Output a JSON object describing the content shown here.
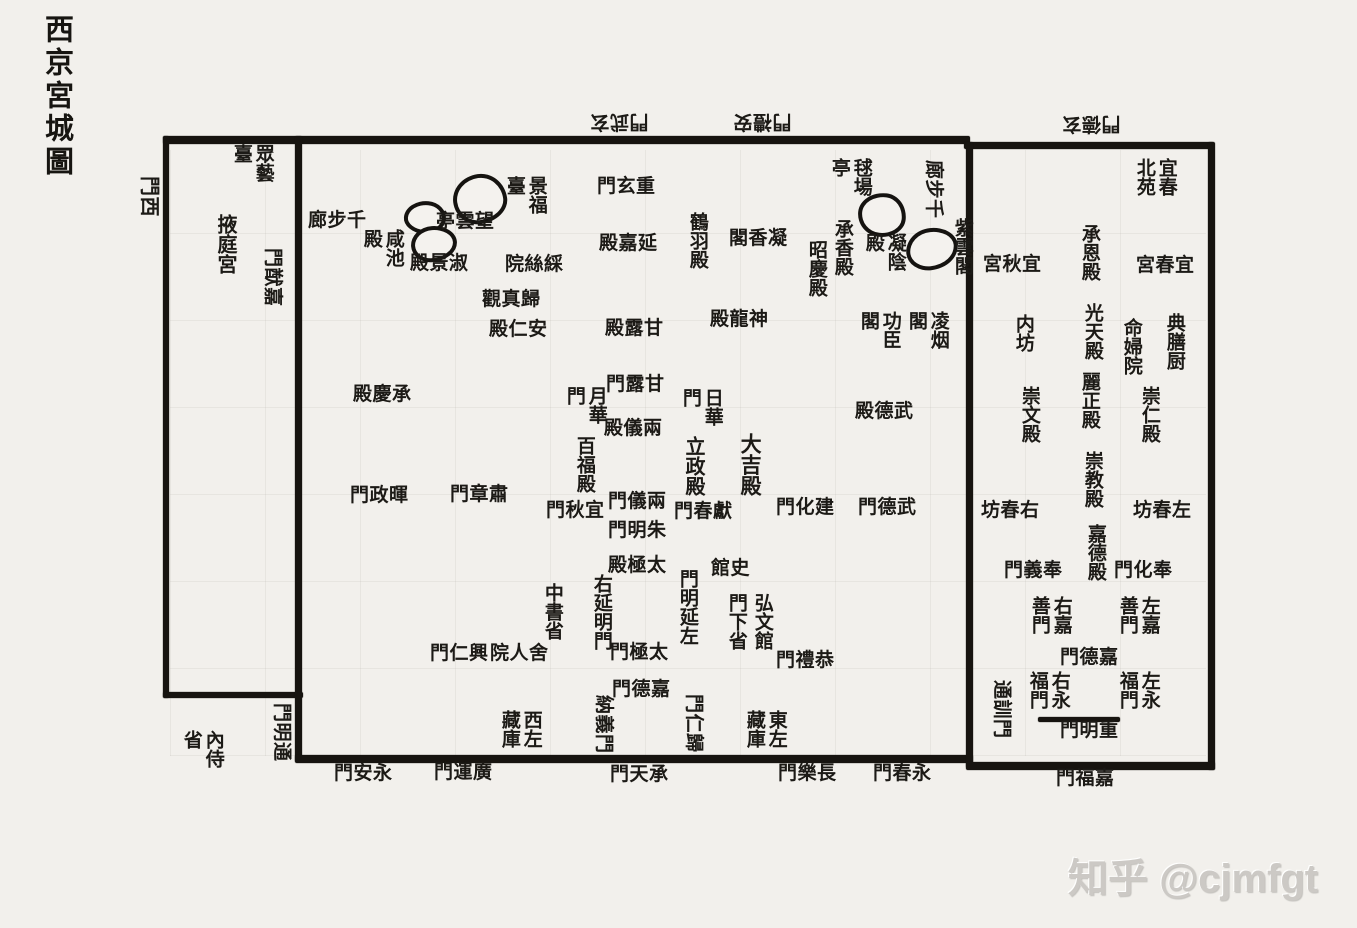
{
  "page": {
    "title_vertical": "西京宮城圖",
    "watermark": "知乎 @cjmfgt"
  },
  "colors": {
    "paper": "#f2f0ec",
    "ink": "#1c1a16",
    "wall": "#171410",
    "watermark": "#ccc9c5"
  },
  "map": {
    "width": 1357,
    "height": 928,
    "walls": [
      {
        "name": "north-wall-main",
        "x": 163,
        "y": 136,
        "w": 807,
        "h": 8
      },
      {
        "name": "north-wall-east",
        "x": 964,
        "y": 142,
        "w": 250,
        "h": 7
      },
      {
        "name": "west-wall",
        "x": 163,
        "y": 136,
        "w": 6,
        "h": 562
      },
      {
        "name": "yeting-south-wall",
        "x": 163,
        "y": 692,
        "w": 140,
        "h": 6
      },
      {
        "name": "yeting-east-wall",
        "x": 295,
        "y": 136,
        "w": 7,
        "h": 626
      },
      {
        "name": "south-wall-main",
        "x": 295,
        "y": 755,
        "w": 678,
        "h": 8
      },
      {
        "name": "eastpalace-west-wall",
        "x": 966,
        "y": 142,
        "w": 7,
        "h": 626
      },
      {
        "name": "eastpalace-east-wall",
        "x": 1208,
        "y": 142,
        "w": 7,
        "h": 628
      },
      {
        "name": "eastpalace-south-wall",
        "x": 966,
        "y": 762,
        "w": 249,
        "h": 8
      },
      {
        "name": "chongming-gate-bar",
        "x": 1038,
        "y": 717,
        "w": 82,
        "h": 5
      }
    ],
    "ponds": [
      {
        "name": "pond-1",
        "x": 453,
        "y": 174,
        "w": 46,
        "h": 42,
        "radius": "52% 48% 55% 45% / 50% 55% 45% 50%",
        "rot": -8
      },
      {
        "name": "pond-2",
        "x": 404,
        "y": 201,
        "w": 34,
        "h": 25,
        "radius": "55% 45% 50% 50% / 55% 50% 50% 45%",
        "rot": 5
      },
      {
        "name": "pond-3",
        "x": 411,
        "y": 226,
        "w": 38,
        "h": 28,
        "radius": "48% 52% 58% 42% / 52% 48% 52% 48%",
        "rot": -4
      },
      {
        "name": "pond-4",
        "x": 858,
        "y": 193,
        "w": 40,
        "h": 36,
        "radius": "55% 45% 52% 48% / 48% 55% 45% 52%",
        "rot": 6
      },
      {
        "name": "pond-5",
        "x": 906,
        "y": 228,
        "w": 44,
        "h": 34,
        "radius": "50% 50% 56% 44% / 55% 45% 55% 45%",
        "rot": -6
      }
    ],
    "labels": [
      {
        "name": "xuanwu-gate",
        "text": "門武玄",
        "reading": "玄武門",
        "x": 590,
        "y": 111,
        "mode": "h",
        "rot": 180
      },
      {
        "name": "anli-gate",
        "text": "門禮安",
        "reading": "安禮門",
        "x": 733,
        "y": 111,
        "mode": "h",
        "rot": 180
      },
      {
        "name": "xuande-gate",
        "text": "門德玄",
        "reading": "玄德門",
        "x": 1062,
        "y": 113,
        "mode": "h",
        "rot": 180
      },
      {
        "name": "xi-gate",
        "text": "門西",
        "reading": "西門",
        "x": 135,
        "y": 176,
        "mode": "h",
        "rot": 90,
        "size": 20
      },
      {
        "name": "jiayou-gate",
        "text": "門猷嘉",
        "reading": "嘉猷門",
        "x": 259,
        "y": 248,
        "mode": "h",
        "rot": 90
      },
      {
        "name": "tongming-gate",
        "text": "門明通",
        "reading": "通明門",
        "x": 268,
        "y": 703,
        "mode": "h",
        "rot": 90
      },
      {
        "name": "tongxun-gate",
        "text": "通訓門",
        "reading": "通訓門",
        "x": 988,
        "y": 680,
        "mode": "h",
        "rot": 90
      },
      {
        "name": "zhongyi-terrace",
        "text": "眾藝臺",
        "reading": "眾藝臺",
        "x": 230,
        "y": 144,
        "mode": "v",
        "colh": 2
      },
      {
        "name": "yeting-palace",
        "text": "掖庭宮",
        "reading": "掖庭宮",
        "x": 213,
        "y": 214,
        "mode": "v",
        "size": 20
      },
      {
        "name": "neishi-department",
        "text": "內侍省",
        "reading": "內侍省",
        "x": 180,
        "y": 730,
        "mode": "v",
        "colh": 2
      },
      {
        "name": "qianbulang-west",
        "text": "廊步千",
        "reading": "千步廊",
        "x": 308,
        "y": 211,
        "mode": "h"
      },
      {
        "name": "wangyun-pavilion",
        "text": "亭雲望",
        "reading": "望雲亭",
        "x": 436,
        "y": 212,
        "mode": "h"
      },
      {
        "name": "jingfu-terrace",
        "text": "景福臺",
        "reading": "景福臺",
        "x": 503,
        "y": 176,
        "mode": "v",
        "colh": 2
      },
      {
        "name": "xianchi-hall",
        "text": "咸池殿",
        "reading": "咸池殿",
        "x": 360,
        "y": 229,
        "mode": "v",
        "colh": 2
      },
      {
        "name": "shujing-hall",
        "text": "殿景淑",
        "reading": "淑景殿",
        "x": 410,
        "y": 254,
        "mode": "h"
      },
      {
        "name": "caisi-court",
        "text": "院絲綵",
        "reading": "綵絲院",
        "x": 505,
        "y": 255,
        "mode": "h"
      },
      {
        "name": "guizhen-abbey",
        "text": "觀真歸",
        "reading": "歸真觀",
        "x": 482,
        "y": 290,
        "mode": "h"
      },
      {
        "name": "anren-hall",
        "text": "殿仁安",
        "reading": "安仁殿",
        "x": 489,
        "y": 320,
        "mode": "h"
      },
      {
        "name": "chongxuan-gate",
        "text": "門玄重",
        "reading": "重玄門",
        "x": 597,
        "y": 177,
        "mode": "h"
      },
      {
        "name": "yanjia-hall",
        "text": "殿嘉延",
        "reading": "延嘉殿",
        "x": 599,
        "y": 234,
        "mode": "h"
      },
      {
        "name": "ganlu-hall",
        "text": "殿露甘",
        "reading": "甘露殿",
        "x": 605,
        "y": 319,
        "mode": "h"
      },
      {
        "name": "heyu-hall",
        "text": "鶴羽殿",
        "reading": "鶴羽殿",
        "x": 686,
        "y": 212,
        "mode": "v"
      },
      {
        "name": "ningxiang-pavilion",
        "text": "閣香凝",
        "reading": "凝香閣",
        "x": 729,
        "y": 229,
        "mode": "h"
      },
      {
        "name": "chengxiang-hall",
        "text": "承香殿",
        "reading": "承香殿",
        "x": 831,
        "y": 219,
        "mode": "v"
      },
      {
        "name": "zhaoqing-hall",
        "text": "昭慶殿",
        "reading": "昭慶殿",
        "x": 805,
        "y": 240,
        "mode": "v"
      },
      {
        "name": "qiuchang-pavilion",
        "text": "毬場亭",
        "reading": "毬場亭",
        "x": 828,
        "y": 158,
        "mode": "v",
        "colh": 2
      },
      {
        "name": "qianbulang-north",
        "text": "廊步千",
        "reading": "千步廊",
        "x": 920,
        "y": 160,
        "mode": "h",
        "rot": 90
      },
      {
        "name": "ziyun-pavilion",
        "text": "紫雲閣",
        "reading": "紫雲閣",
        "x": 951,
        "y": 218,
        "mode": "v"
      },
      {
        "name": "ningyin-hall",
        "text": "凝陰殿",
        "reading": "凝陰殿",
        "x": 862,
        "y": 233,
        "mode": "v",
        "colh": 2
      },
      {
        "name": "shenlong-hall",
        "text": "殿龍神",
        "reading": "神龍殿",
        "x": 710,
        "y": 310,
        "mode": "h"
      },
      {
        "name": "gongchen-pavilion",
        "text": "功臣閣",
        "reading": "功臣閣",
        "x": 857,
        "y": 311,
        "mode": "v",
        "colh": 2
      },
      {
        "name": "lingyan-pavilion",
        "text": "凌烟閣",
        "reading": "凌烟閣",
        "x": 905,
        "y": 311,
        "mode": "v",
        "colh": 2
      },
      {
        "name": "chengqing-hall",
        "text": "殿慶承",
        "reading": "承慶殿",
        "x": 353,
        "y": 385,
        "mode": "h"
      },
      {
        "name": "ganlu-gate",
        "text": "門露甘",
        "reading": "甘露門",
        "x": 606,
        "y": 375,
        "mode": "h"
      },
      {
        "name": "yuehua-gate",
        "text": "月華門",
        "reading": "月華門",
        "x": 563,
        "y": 386,
        "mode": "v",
        "colh": 2
      },
      {
        "name": "rihua-gate",
        "text": "日華門",
        "reading": "日華門",
        "x": 679,
        "y": 388,
        "mode": "v",
        "colh": 2
      },
      {
        "name": "liangyi-hall",
        "text": "殿儀兩",
        "reading": "兩儀殿",
        "x": 604,
        "y": 419,
        "mode": "h"
      },
      {
        "name": "baifu-hall",
        "text": "百福殿",
        "reading": "百福殿",
        "x": 573,
        "y": 436,
        "mode": "v"
      },
      {
        "name": "lizheng-hall",
        "text": "立政殿",
        "reading": "立政殿",
        "x": 681,
        "y": 436,
        "mode": "v",
        "size": 20
      },
      {
        "name": "daji-hall",
        "text": "大吉殿",
        "reading": "大吉殿",
        "x": 738,
        "y": 433,
        "mode": "v",
        "size": 21
      },
      {
        "name": "wude-hall",
        "text": "殿德武",
        "reading": "武德殿",
        "x": 855,
        "y": 402,
        "mode": "h"
      },
      {
        "name": "huizheng-gate",
        "text": "門政暉",
        "reading": "暉政門",
        "x": 350,
        "y": 486,
        "mode": "h"
      },
      {
        "name": "suzhang-gate",
        "text": "門章肅",
        "reading": "肅章門",
        "x": 450,
        "y": 485,
        "mode": "h"
      },
      {
        "name": "yiqiu-gate",
        "text": "門秋宜",
        "reading": "宜秋門",
        "x": 546,
        "y": 501,
        "mode": "h"
      },
      {
        "name": "liangyi-gate",
        "text": "門儀兩",
        "reading": "兩儀門",
        "x": 608,
        "y": 492,
        "mode": "h"
      },
      {
        "name": "zhuming-gate",
        "text": "門明朱",
        "reading": "朱明門",
        "x": 608,
        "y": 521,
        "mode": "h"
      },
      {
        "name": "xianchun-gate",
        "text": "門春獻",
        "reading": "獻春門",
        "x": 674,
        "y": 502,
        "mode": "h"
      },
      {
        "name": "jianhua-gate",
        "text": "門化建",
        "reading": "建化門",
        "x": 776,
        "y": 498,
        "mode": "h"
      },
      {
        "name": "wude-gate",
        "text": "門德武",
        "reading": "武德門",
        "x": 858,
        "y": 498,
        "mode": "h"
      },
      {
        "name": "taiji-hall",
        "text": "殿極太",
        "reading": "太極殿",
        "x": 608,
        "y": 556,
        "mode": "h"
      },
      {
        "name": "shi-guan",
        "text": "館史",
        "reading": "史館",
        "x": 711,
        "y": 559,
        "mode": "h"
      },
      {
        "name": "you-yanming-gate",
        "text": "右延明門",
        "reading": "右延明門",
        "x": 590,
        "y": 574,
        "mode": "v"
      },
      {
        "name": "zuo-yanming-gate",
        "text": "門明延左",
        "reading": "左延明門",
        "x": 676,
        "y": 569,
        "mode": "v"
      },
      {
        "name": "zhongshu-department",
        "text": "中書省",
        "reading": "中書省",
        "x": 541,
        "y": 583,
        "mode": "v"
      },
      {
        "name": "hongwen-academy",
        "text": "弘文館",
        "reading": "弘文館",
        "x": 751,
        "y": 593,
        "mode": "v"
      },
      {
        "name": "menxia-department",
        "text": "門下省",
        "reading": "門下省",
        "x": 725,
        "y": 593,
        "mode": "v"
      },
      {
        "name": "sheren-court",
        "text": "院人舍",
        "reading": "舍人院",
        "x": 490,
        "y": 644,
        "mode": "h"
      },
      {
        "name": "xingren-gate",
        "text": "門仁興",
        "reading": "興仁門",
        "x": 430,
        "y": 644,
        "mode": "h"
      },
      {
        "name": "taiji-gate",
        "text": "門極太",
        "reading": "太極門",
        "x": 610,
        "y": 643,
        "mode": "h"
      },
      {
        "name": "gongli-gate",
        "text": "門禮恭",
        "reading": "恭禮門",
        "x": 776,
        "y": 651,
        "mode": "h"
      },
      {
        "name": "jiade-gate-inner",
        "text": "門德嘉",
        "reading": "嘉德門",
        "x": 612,
        "y": 680,
        "mode": "h"
      },
      {
        "name": "nayi-gate",
        "text": "納義門",
        "reading": "納義門",
        "x": 590,
        "y": 695,
        "mode": "h",
        "rot": 90
      },
      {
        "name": "guiren-gate",
        "text": "門仁歸",
        "reading": "歸仁門",
        "x": 680,
        "y": 694,
        "mode": "h",
        "rot": 90
      },
      {
        "name": "west-zuocang-store",
        "text": "西左藏庫",
        "reading": "西左藏庫",
        "x": 498,
        "y": 710,
        "mode": "v",
        "colh": 2
      },
      {
        "name": "east-zuocang-store",
        "text": "東左藏庫",
        "reading": "東左藏庫",
        "x": 743,
        "y": 710,
        "mode": "v",
        "colh": 2
      },
      {
        "name": "yichun-north-park",
        "text": "宜春北苑",
        "reading": "宜春北苑",
        "x": 1133,
        "y": 158,
        "mode": "v",
        "colh": 2
      },
      {
        "name": "yiqiu-palace",
        "text": "宮秋宜",
        "reading": "宜秋宮",
        "x": 983,
        "y": 255,
        "mode": "h"
      },
      {
        "name": "chengen-hall",
        "text": "承恩殿",
        "reading": "承恩殿",
        "x": 1078,
        "y": 224,
        "mode": "v"
      },
      {
        "name": "yichun-palace",
        "text": "宮春宜",
        "reading": "宜春宮",
        "x": 1136,
        "y": 256,
        "mode": "h"
      },
      {
        "name": "nei-fang",
        "text": "内坊",
        "reading": "內坊",
        "x": 1012,
        "y": 314,
        "mode": "v"
      },
      {
        "name": "guangtian-hall",
        "text": "光天殿",
        "reading": "光天殿",
        "x": 1081,
        "y": 303,
        "mode": "v"
      },
      {
        "name": "dianshan-kitchen",
        "text": "典膳厨",
        "reading": "典膳厨",
        "x": 1163,
        "y": 313,
        "mode": "v"
      },
      {
        "name": "mingfu-court",
        "text": "命婦院",
        "reading": "命婦院",
        "x": 1120,
        "y": 318,
        "mode": "v"
      },
      {
        "name": "lizheng-hall-east",
        "text": "麗正殿",
        "reading": "麗正殿",
        "x": 1078,
        "y": 372,
        "mode": "v"
      },
      {
        "name": "chongwen-hall",
        "text": "崇文殿",
        "reading": "崇文殿",
        "x": 1018,
        "y": 386,
        "mode": "v"
      },
      {
        "name": "chongren-hall",
        "text": "崇仁殿",
        "reading": "崇仁殿",
        "x": 1138,
        "y": 386,
        "mode": "v"
      },
      {
        "name": "chongjiao-hall",
        "text": "崇教殿",
        "reading": "崇教殿",
        "x": 1081,
        "y": 451,
        "mode": "v"
      },
      {
        "name": "jiade-hall",
        "text": "嘉德殿",
        "reading": "嘉德殿",
        "x": 1084,
        "y": 524,
        "mode": "v"
      },
      {
        "name": "you-chunfang",
        "text": "坊春右",
        "reading": "右春坊",
        "x": 981,
        "y": 501,
        "mode": "h"
      },
      {
        "name": "zuo-chunfang",
        "text": "坊春左",
        "reading": "左春坊",
        "x": 1133,
        "y": 501,
        "mode": "h"
      },
      {
        "name": "fengyi-gate",
        "text": "門義奉",
        "reading": "奉義門",
        "x": 1004,
        "y": 561,
        "mode": "h"
      },
      {
        "name": "fenghua-gate",
        "text": "門化奉",
        "reading": "奉化門",
        "x": 1114,
        "y": 561,
        "mode": "h"
      },
      {
        "name": "you-jiashan-gate",
        "text": "右嘉善門",
        "reading": "右嘉善門",
        "x": 1028,
        "y": 596,
        "mode": "v",
        "colh": 2
      },
      {
        "name": "zuo-jiashan-gate",
        "text": "左嘉善門",
        "reading": "左嘉善門",
        "x": 1116,
        "y": 596,
        "mode": "v",
        "colh": 2
      },
      {
        "name": "jiade-gate-east",
        "text": "門德嘉",
        "reading": "嘉德門",
        "x": 1060,
        "y": 648,
        "mode": "h"
      },
      {
        "name": "you-yongfu-gate",
        "text": "右永福門",
        "reading": "右永福門",
        "x": 1026,
        "y": 671,
        "mode": "v",
        "colh": 2
      },
      {
        "name": "zuo-yongfu-gate",
        "text": "左永福門",
        "reading": "左永福門",
        "x": 1116,
        "y": 671,
        "mode": "v",
        "colh": 2
      },
      {
        "name": "chongming-gate",
        "text": "門明重",
        "reading": "重明門",
        "x": 1060,
        "y": 721,
        "mode": "h"
      },
      {
        "name": "jiafu-gate",
        "text": "門福嘉",
        "reading": "嘉福門",
        "x": 1056,
        "y": 769,
        "mode": "h"
      },
      {
        "name": "yongan-gate",
        "text": "門安永",
        "reading": "永安門",
        "x": 334,
        "y": 764,
        "mode": "h"
      },
      {
        "name": "guangyun-gate",
        "text": "門運廣",
        "reading": "廣運門",
        "x": 434,
        "y": 763,
        "mode": "h"
      },
      {
        "name": "chengtian-gate",
        "text": "門天承",
        "reading": "承天門",
        "x": 610,
        "y": 765,
        "mode": "h"
      },
      {
        "name": "changle-gate",
        "text": "門樂長",
        "reading": "長樂門",
        "x": 778,
        "y": 764,
        "mode": "h"
      },
      {
        "name": "yongchun-gate",
        "text": "門春永",
        "reading": "永春門",
        "x": 873,
        "y": 764,
        "mode": "h"
      }
    ]
  }
}
